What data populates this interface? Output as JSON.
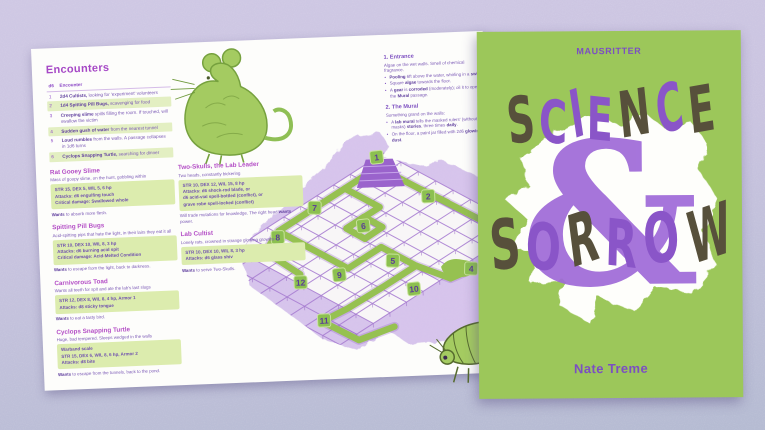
{
  "cover": {
    "logo": "MAUSRITTER",
    "title_word1": "SCIENCE",
    "ampersand": "&",
    "title_word2": "SORROW",
    "science_letters": [
      {
        "ch": "S",
        "c": "dark"
      },
      {
        "ch": "C",
        "c": "purple"
      },
      {
        "ch": "I",
        "c": "purple"
      },
      {
        "ch": "E",
        "c": "purple"
      },
      {
        "ch": "N",
        "c": "dark"
      },
      {
        "ch": "C",
        "c": "purple"
      },
      {
        "ch": "E",
        "c": "dark"
      }
    ],
    "sorrow_letters": [
      {
        "ch": "S",
        "c": "dark"
      },
      {
        "ch": "O",
        "c": "purple"
      },
      {
        "ch": "R",
        "c": "dark"
      },
      {
        "ch": "R",
        "c": "purple"
      },
      {
        "ch": "O",
        "c": "purple"
      },
      {
        "ch": "W",
        "c": "dark"
      }
    ],
    "author": "Nate Treme",
    "colors": {
      "background": "#9cc75a",
      "letter_dark": "#57503b",
      "letter_purple": "#8a55c8",
      "logo_purple": "#7b4fc2",
      "blob_white": "#fefefb"
    }
  },
  "spread": {
    "encounters": {
      "title": "Encounters",
      "header_num": "d6",
      "header_label": "Encounter",
      "rows": [
        {
          "n": "1",
          "text": "**2d4 Cultists,** looking for 'experiment' volunteers",
          "shaded": false
        },
        {
          "n": "2",
          "text": "**1d4 Spitting Pill Bugs,** scavenging for food",
          "shaded": true
        },
        {
          "n": "3",
          "text": "**Creeping slime** spills filling the room. If touched, will swallow the victim",
          "shaded": false
        },
        {
          "n": "4",
          "text": "**Sudden gush of water** from the nearest tunnel",
          "shaded": true
        },
        {
          "n": "5",
          "text": "**Loud rumbles** from the walls. A passage collapses in 1d6 turns",
          "shaded": false
        },
        {
          "n": "6",
          "text": "**Cyclops Snapping Turtle,** searching for dinner",
          "shaded": true
        }
      ]
    },
    "monsters": [
      {
        "name": "Rat Gooey Slime",
        "subtitle": "Mass of goopy slime, on the hunt, gobbling within",
        "stats": [
          "STR 15, DEX 5, WIL 5, 6 hp",
          "Attacks: d6 engulfing touch",
          "Critical damage: Swallowed whole"
        ],
        "wants": "**Wants** to absorb more flesh."
      },
      {
        "name": "Spitting Pill Bugs",
        "subtitle": "Acid-spitting pips that hate the light, in their lairs they eat it all",
        "stats": [
          "STR 10, DEX 10, WIL 8, 3 hp",
          "Attacks: d6 burning acid spit",
          "Critical damage: Acid-Melted Condition"
        ],
        "wants": "**Wants** to escape from the light, back to darkness."
      },
      {
        "name": "Carnivorous Toad",
        "subtitle": "Wants all teeth for spit and ate the lab's last slugs",
        "stats": [
          "STR 12, DEX 8, WIL 8, 4 hp, Armor 1",
          "Attacks: d8 sticky tongue"
        ],
        "wants": "**Wants** to eat a tasty bird."
      },
      {
        "name": "Cyclops Snapping Turtle",
        "subtitle": "Huge, bad tempered. Sleeps wedged in the walls",
        "stats": [
          "Warband scale",
          "STR 15, DEX 6, WIL 8, 6 hp, Armor 2",
          "Attacks: d8 bite"
        ],
        "wants": "**Wants** to escape from the tunnels, back to the pond."
      }
    ],
    "npcs": [
      {
        "name": "Two-Skulls, the Lab Leader",
        "subtitle": "Two heads, constantly bickering",
        "stats": [
          "STR 10, DEX 12, WIL 15, 8 hp",
          "Attacks: d6 shock-rod blade, or",
          "d6 acid-vial spell-bottled (conflict), or",
          "grave robe spell-locked (conflict)"
        ],
        "wants": "Will trade mutations for knowledge. The right head **wants** power."
      },
      {
        "name": "Lab Cultist",
        "subtitle": "Lonely rats, crowned in strange glowing growths",
        "stats": [
          "STR 10, DEX 10, WIL 8, 3 hp",
          "Attacks: d6 glass shiv"
        ],
        "wants": "**Wants** to serve Two-Skulls."
      }
    ],
    "rooms": [
      {
        "name": "1. Entrance",
        "intro": "Algae on the wet walls. Smell of chemical fragrance.",
        "bullets": [
          "**Pooling** 6ft above the water, whirling in a **swirl**.",
          "Square **algae** towards the floor.",
          "A **gear** is **corroded** (moderately); oil it to open the **Mural** passage."
        ]
      },
      {
        "name": "2. The Mural",
        "intro": "Something grand on the walls:",
        "bullets": [
          "A **lab mural** tells the masked rulers' (without masks) **stories**, three times **daily**.",
          "On the floor, a paint jar filled with 2d6 **glowing dust**."
        ]
      }
    ],
    "map": {
      "tokens": [
        {
          "n": "1",
          "x": 145,
          "y": 26
        },
        {
          "n": "2",
          "x": 195,
          "y": 67
        },
        {
          "n": "7",
          "x": 81,
          "y": 74
        },
        {
          "n": "6",
          "x": 129,
          "y": 94
        },
        {
          "n": "8",
          "x": 43,
          "y": 102
        },
        {
          "n": "5",
          "x": 157,
          "y": 130
        },
        {
          "n": "9",
          "x": 103,
          "y": 142
        },
        {
          "n": "12",
          "x": 64,
          "y": 148
        },
        {
          "n": "4",
          "x": 235,
          "y": 141
        },
        {
          "n": "10",
          "x": 177,
          "y": 159
        },
        {
          "n": "11",
          "x": 86,
          "y": 187
        }
      ],
      "token_fill": "#8cc050",
      "token_number_color": "#5c3d96",
      "path_green": "#96c151",
      "rock_purple": "#d7c5ec"
    }
  }
}
